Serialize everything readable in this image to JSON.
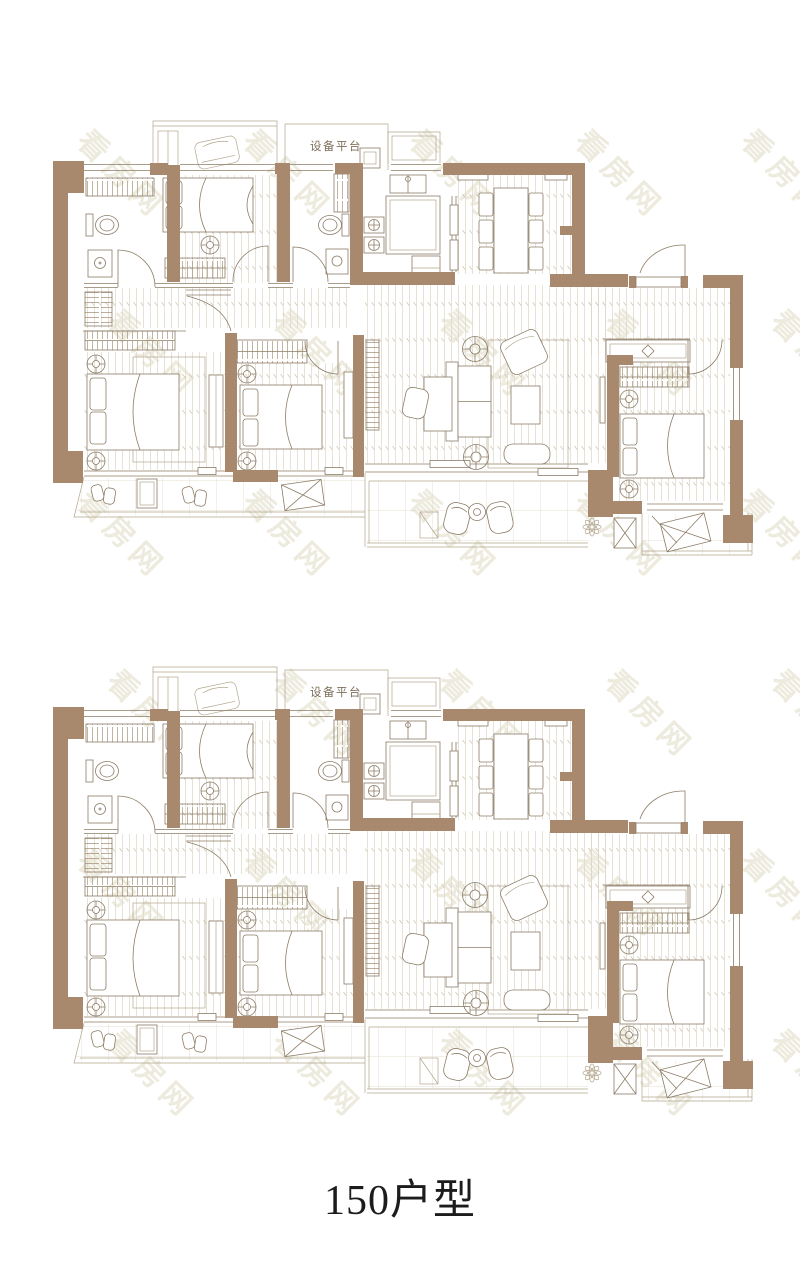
{
  "caption": {
    "text": "150户型"
  },
  "plan": {
    "platform_label": "设备平台"
  },
  "watermark": {
    "text": "看房网"
  },
  "colors": {
    "wall": "#a8896d",
    "line": "#8c7c66",
    "light": "#b3a68e",
    "hatch": "#a4937a",
    "floor": "#ddd5c5",
    "tile": "#cfc6b4",
    "wm": "#edeade",
    "label": "#7d6f5a",
    "caption": "#1c1c1c"
  }
}
